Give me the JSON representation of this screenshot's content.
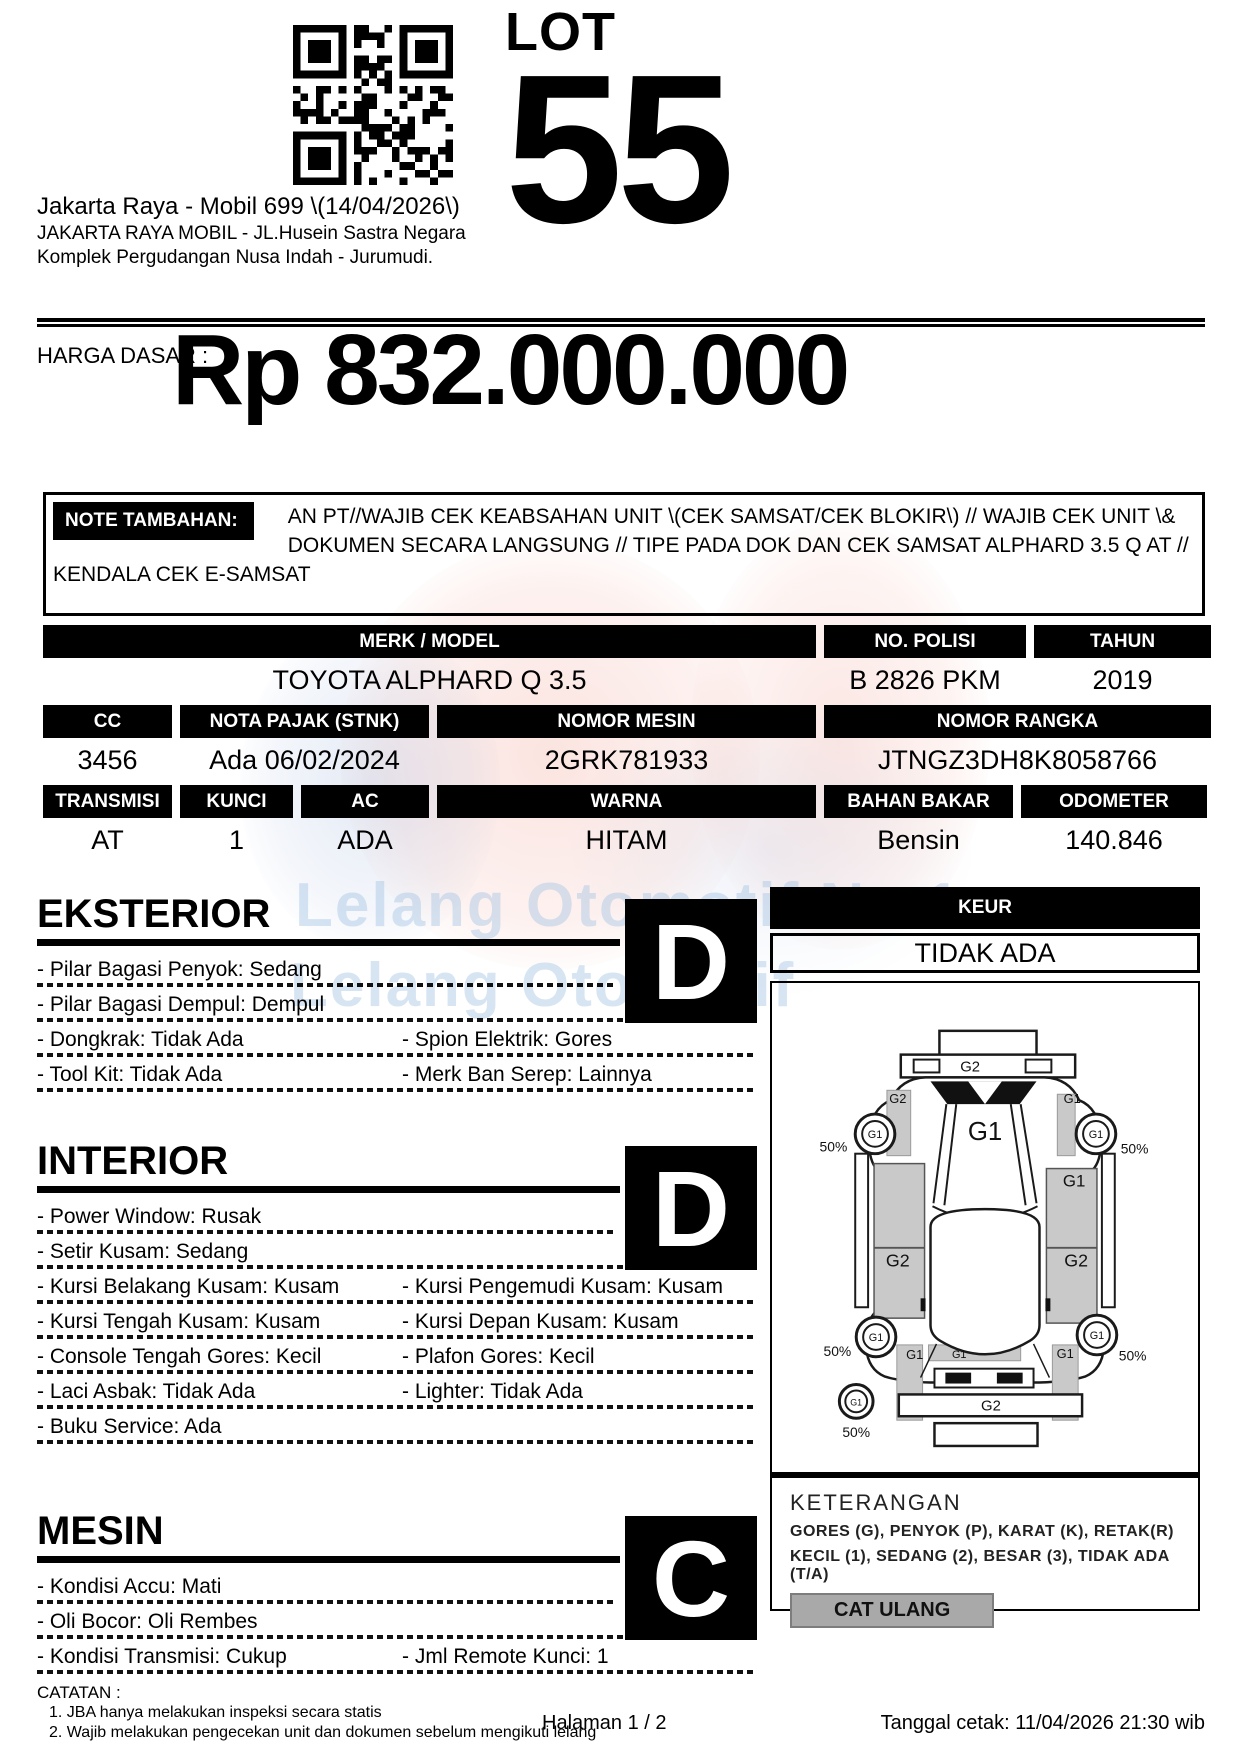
{
  "header": {
    "auction_title": "Jakarta Raya - Mobil 699 \\(14/04/2026\\)",
    "venue_line1": "JAKARTA RAYA MOBIL - JL.Husein Sastra Negara",
    "venue_line2": "Komplek Pergudangan Nusa Indah - Jurumudi.",
    "lot_label": "LOT",
    "lot_number": "55"
  },
  "price": {
    "label": "HARGA DASAR :",
    "value": "Rp 832.000.000"
  },
  "note": {
    "label": "NOTE TAMBAHAN:",
    "text": "AN PT//WAJIB CEK KEABSAHAN UNIT \\(CEK SAMSAT/CEK BLOKIR\\) // WAJIB CEK UNIT \\& DOKUMEN SECARA LANGSUNG // TIPE PADA DOK DAN CEK SAMSAT ALPHARD 3.5 Q AT // KENDALA CEK E-SAMSAT"
  },
  "specs": {
    "row1": {
      "headers": [
        "MERK / MODEL",
        "NO. POLISI",
        "TAHUN"
      ],
      "values": [
        "TOYOTA ALPHARD Q 3.5",
        "B 2826 PKM",
        "2019"
      ]
    },
    "row2": {
      "headers": [
        "CC",
        "NOTA PAJAK (STNK)",
        "NOMOR MESIN",
        "NOMOR RANGKA"
      ],
      "values": [
        "3456",
        "Ada 06/02/2024",
        "2GRK781933",
        "JTNGZ3DH8K8058766"
      ]
    },
    "row3": {
      "headers": [
        "TRANSMISI",
        "KUNCI",
        "AC",
        "WARNA",
        "BAHAN BAKAR",
        "ODOMETER"
      ],
      "values": [
        "AT",
        "1",
        "ADA",
        "HITAM",
        "Bensin",
        "140.846"
      ]
    }
  },
  "sections": {
    "eksterior": {
      "title": "EKSTERIOR",
      "grade": "D",
      "rows": [
        {
          "left": "- Pilar Bagasi Penyok: Sedang",
          "right": ""
        },
        {
          "left": "- Pilar Bagasi Dempul: Dempul",
          "right": ""
        },
        {
          "left": "- Dongkrak: Tidak Ada",
          "right": "- Spion Elektrik: Gores"
        },
        {
          "left": "- Tool Kit: Tidak Ada",
          "right": "- Merk Ban Serep: Lainnya"
        }
      ]
    },
    "interior": {
      "title": "INTERIOR",
      "grade": "D",
      "rows": [
        {
          "left": "- Power Window: Rusak",
          "right": ""
        },
        {
          "left": "- Setir Kusam: Sedang",
          "right": ""
        },
        {
          "left": "- Kursi Belakang Kusam: Kusam",
          "right": "- Kursi Pengemudi Kusam: Kusam"
        },
        {
          "left": "- Kursi Tengah Kusam: Kusam",
          "right": "- Kursi Depan Kusam: Kusam"
        },
        {
          "left": "- Console Tengah Gores: Kecil",
          "right": "- Plafon Gores: Kecil"
        },
        {
          "left": "- Laci Asbak: Tidak Ada",
          "right": "- Lighter: Tidak Ada"
        },
        {
          "left": "- Buku Service: Ada",
          "right": ""
        }
      ]
    },
    "mesin": {
      "title": "MESIN",
      "grade": "C",
      "rows": [
        {
          "left": "- Kondisi Accu: Mati",
          "right": ""
        },
        {
          "left": "- Oli Bocor: Oli Rembes",
          "right": ""
        },
        {
          "left": "- Kondisi Transmisi: Cukup",
          "right": "- Jml Remote Kunci: 1"
        }
      ]
    }
  },
  "keur": {
    "label": "KEUR",
    "value": "TIDAK ADA"
  },
  "diagram": {
    "labels": {
      "rear_bar": "G2",
      "rear_fender_left": "G2",
      "rear_fender_right": "G1",
      "roof": "G1",
      "door_right_top": "G1",
      "door_left": "G2",
      "door_right": "G2",
      "sill_left": "G1",
      "sill_right": "G1",
      "rocker": "G1",
      "front_bar": "G2",
      "wheel": "G1",
      "percent": "50%"
    }
  },
  "keterangan": {
    "title": "KETERANGAN",
    "line1": "GORES (G), PENYOK (P), KARAT (K), RETAK(R)",
    "line2": "KECIL (1), SEDANG (2), BESAR (3), TIDAK ADA (T/A)",
    "button": "CAT ULANG"
  },
  "catatan": {
    "label": "CATATAN :",
    "items": [
      "1. JBA hanya melakukan inspeksi secara statis",
      "2. Wajib melakukan pengecekan unit dan dokumen sebelum mengikuti lelang"
    ]
  },
  "footer": {
    "page": "Halaman 1 / 2",
    "printed": "Tanggal cetak: 11/04/2026 21:30 wib"
  },
  "watermark": {
    "line1": "Lelang Otomotif No.1",
    "line2": "Lelang Otomotif"
  }
}
